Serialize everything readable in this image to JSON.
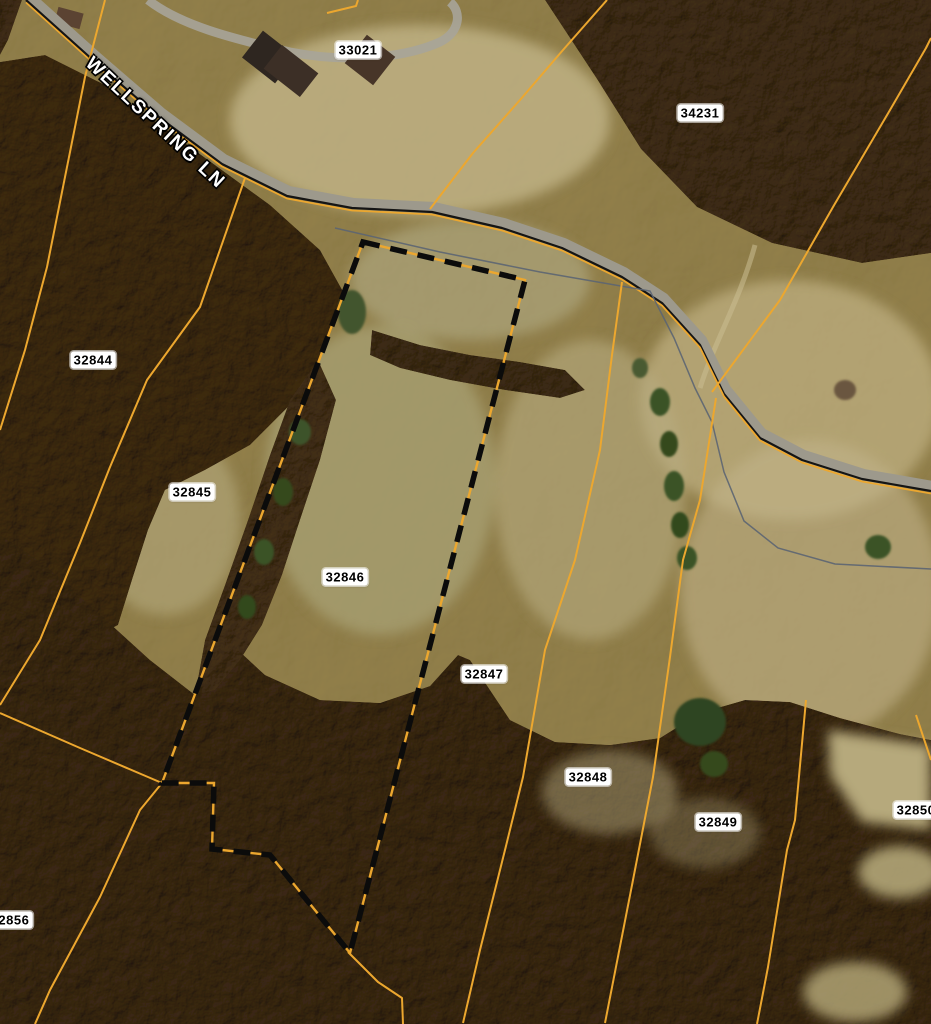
{
  "map": {
    "type": "aerial-parcel-map",
    "road_label": "WELLSPRING LN",
    "selected_parcel_id": "32846",
    "colors": {
      "parcel_line": "#eca72f",
      "selection_dash": "#0b0b0b",
      "road_casing": "#151515",
      "road_surface": "#9d998c",
      "stream_line": "#5c6572",
      "label_bg": "#ffffff",
      "label_text": "#000000"
    },
    "parcel_labels": [
      {
        "id": "33021",
        "x": 358,
        "y": 50
      },
      {
        "id": "34231",
        "x": 700,
        "y": 113
      },
      {
        "id": "32844",
        "x": 93,
        "y": 360
      },
      {
        "id": "32845",
        "x": 192,
        "y": 492
      },
      {
        "id": "32846",
        "x": 345,
        "y": 577
      },
      {
        "id": "32847",
        "x": 484,
        "y": 674
      },
      {
        "id": "32848",
        "x": 588,
        "y": 777
      },
      {
        "id": "32849",
        "x": 718,
        "y": 822
      },
      {
        "id": "32850",
        "x": 916,
        "y": 810
      },
      {
        "id": "32856",
        "x": 10,
        "y": 920
      }
    ],
    "geometry": {
      "road_path": [
        [
          26,
          0
        ],
        [
          95,
          62
        ],
        [
          160,
          118
        ],
        [
          222,
          164
        ],
        [
          287,
          196
        ],
        [
          352,
          208
        ],
        [
          432,
          212
        ],
        [
          502,
          228
        ],
        [
          562,
          248
        ],
        [
          622,
          277
        ],
        [
          662,
          303
        ],
        [
          700,
          345
        ],
        [
          724,
          394
        ],
        [
          760,
          438
        ],
        [
          802,
          460
        ],
        [
          862,
          479
        ],
        [
          931,
          491
        ]
      ],
      "stream_path": [
        [
          335,
          228
        ],
        [
          440,
          252
        ],
        [
          540,
          272
        ],
        [
          650,
          291
        ],
        [
          674,
          338
        ],
        [
          695,
          388
        ],
        [
          712,
          422
        ],
        [
          724,
          472
        ],
        [
          744,
          521
        ],
        [
          778,
          548
        ],
        [
          835,
          564
        ],
        [
          931,
          569
        ]
      ],
      "selected_boundary": [
        [
          363,
          242
        ],
        [
          525,
          280
        ],
        [
          350,
          953
        ],
        [
          270,
          855
        ],
        [
          212,
          849
        ],
        [
          214,
          783
        ],
        [
          162,
          783
        ]
      ],
      "parcel_lines": [
        {
          "name": "line-west-woods",
          "points": [
            [
              105,
              0
            ],
            [
              85,
              77
            ],
            [
              47,
              267
            ],
            [
              25,
              350
            ],
            [
              0,
              430
            ]
          ]
        },
        {
          "name": "line-top-corner",
          "points": [
            [
              327,
              13
            ],
            [
              356,
              6
            ],
            [
              358,
              0
            ]
          ]
        },
        {
          "name": "line-33021-34231",
          "points": [
            [
              430,
              209
            ],
            [
              473,
              153
            ],
            [
              520,
              100
            ],
            [
              563,
              50
            ],
            [
              607,
              0
            ]
          ]
        },
        {
          "name": "line-northeast-diag",
          "points": [
            [
              712,
              392
            ],
            [
              780,
              300
            ],
            [
              833,
              207
            ],
            [
              890,
              110
            ],
            [
              926,
              48
            ],
            [
              931,
              38
            ]
          ]
        },
        {
          "name": "line-mid-east",
          "points": [
            [
              716,
              398
            ],
            [
              700,
              500
            ],
            [
              683,
              560
            ],
            [
              670,
              657
            ],
            [
              653,
              777
            ],
            [
              633,
              880
            ],
            [
              605,
              1023
            ]
          ]
        },
        {
          "name": "line-32847-32848",
          "points": [
            [
              622,
              282
            ],
            [
              612,
              355
            ],
            [
              600,
              450
            ],
            [
              575,
              560
            ],
            [
              545,
              650
            ],
            [
              523,
              777
            ],
            [
              505,
              850
            ],
            [
              480,
              950
            ],
            [
              463,
              1023
            ]
          ]
        },
        {
          "name": "line-32844-32845",
          "points": [
            [
              245,
              178
            ],
            [
              200,
              307
            ],
            [
              147,
              380
            ],
            [
              110,
              467
            ],
            [
              80,
              543
            ],
            [
              40,
              640
            ],
            [
              0,
              705
            ]
          ]
        },
        {
          "name": "line-junction-downleft",
          "points": [
            [
              162,
              783
            ],
            [
              140,
              810
            ],
            [
              100,
              897
            ],
            [
              50,
              990
            ],
            [
              35,
              1024
            ]
          ]
        },
        {
          "name": "line-junction-upleft",
          "points": [
            [
              162,
              783
            ],
            [
              80,
              748
            ],
            [
              0,
              713
            ]
          ]
        },
        {
          "name": "line-tip-south",
          "points": [
            [
              348,
              952
            ],
            [
              378,
              982
            ],
            [
              402,
              998
            ],
            [
              403,
              1024
            ]
          ]
        },
        {
          "name": "line-32849-east",
          "points": [
            [
              806,
              700
            ],
            [
              795,
              820
            ],
            [
              787,
              850
            ],
            [
              768,
              967
            ],
            [
              757,
              1024
            ]
          ]
        },
        {
          "name": "line-far-right",
          "points": [
            [
              916,
              715
            ],
            [
              931,
              760
            ]
          ]
        }
      ]
    }
  }
}
